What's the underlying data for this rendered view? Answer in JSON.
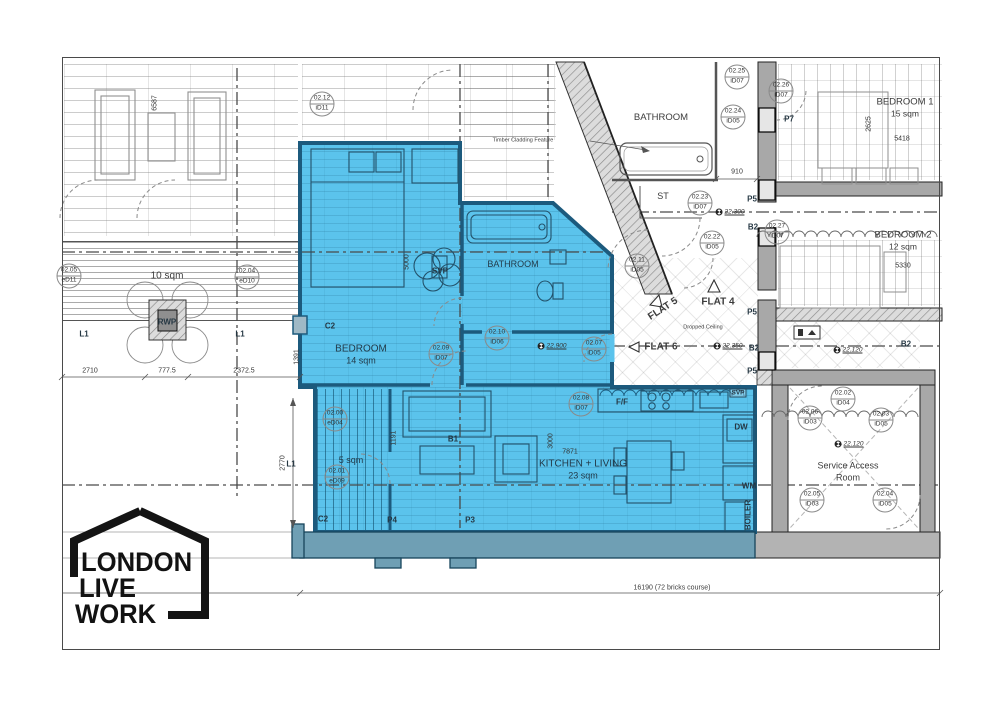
{
  "title": "Live/Work flat floor plan",
  "logo": {
    "line1": "LONDON",
    "line2": "LIVE",
    "line3": "WORK"
  },
  "colors": {
    "highlight": "#5bc3ec",
    "highlight_wall": "#1c5a7d",
    "parapet": "#6f9fb4",
    "wall_grey": "#a8a8a8"
  },
  "rooms": {
    "bedroom": {
      "name": "BEDROOM",
      "area": "14 sqm"
    },
    "bathroom_main": {
      "name": "BATHROOM"
    },
    "kitchen_living": {
      "name": "KITCHEN + LIVING",
      "area": "23 sqm"
    },
    "terrace": {
      "area": "5 sqm"
    },
    "roof_terrace": {
      "area": "10 sqm"
    },
    "bathroom_upper": {
      "name": "BATHROOM"
    },
    "store": {
      "name": "ST"
    },
    "flat4": {
      "name": "FLAT 4"
    },
    "flat5": {
      "name": "FLAT 5"
    },
    "flat6": {
      "name": "FLAT 6"
    },
    "bedroom1": {
      "name": "BEDROOM 1",
      "area": "15 sqm"
    },
    "bedroom2": {
      "name": "BEDROOM 2",
      "area": "12 sqm"
    },
    "service_room": {
      "name": "Service Access",
      "name2": "Room"
    }
  },
  "notes": {
    "timber_cladding": "Timber Cladding Feature",
    "dropped_ceiling": "Dropped Ceiling",
    "overall_dimension": "16190 (72 bricks course)"
  },
  "annotations": {
    "door_tags": [
      {
        "code": "02.12",
        "id": "iD11",
        "x": 322,
        "y": 104
      },
      {
        "code": "02.25",
        "id": "iD07",
        "x": 737,
        "y": 77
      },
      {
        "code": "02.26",
        "id": "iD07",
        "x": 781,
        "y": 91
      },
      {
        "code": "02.24",
        "id": "iD05",
        "x": 733,
        "y": 117
      },
      {
        "code": "02.23",
        "id": "iD07",
        "x": 700,
        "y": 203
      },
      {
        "code": "02.22",
        "id": "iD05",
        "x": 712,
        "y": 243
      },
      {
        "code": "02.11",
        "id": "iD05",
        "x": 637,
        "y": 266
      },
      {
        "code": "02.27",
        "id": "iD07",
        "x": 777,
        "y": 232
      },
      {
        "code": "02.10",
        "id": "iD06",
        "x": 497,
        "y": 338
      },
      {
        "code": "02.09",
        "id": "iD07",
        "x": 441,
        "y": 354
      },
      {
        "code": "02.07",
        "id": "iD05",
        "x": 594,
        "y": 349
      },
      {
        "code": "02.08",
        "id": "iD07",
        "x": 581,
        "y": 404
      },
      {
        "code": "02.05",
        "id": "eD11",
        "x": 69,
        "y": 276
      },
      {
        "code": "02.04",
        "id": "eD10",
        "x": 247,
        "y": 277
      },
      {
        "code": "02.00",
        "id": "eD04",
        "x": 335,
        "y": 419
      },
      {
        "code": "02.01",
        "id": "eD09",
        "x": 337,
        "y": 477
      },
      {
        "code": "02.02",
        "id": "iD04",
        "x": 843,
        "y": 399
      },
      {
        "code": "02.06",
        "id": "iD03",
        "x": 810,
        "y": 418
      },
      {
        "code": "02.03",
        "id": "iD05",
        "x": 881,
        "y": 420
      },
      {
        "code": "02.05",
        "id": "iD03",
        "x": 812,
        "y": 500
      },
      {
        "code": "02.04",
        "id": "iD05",
        "x": 885,
        "y": 500
      }
    ],
    "markers": [
      {
        "text": "P7",
        "x": 789,
        "y": 119
      },
      {
        "text": "P5",
        "x": 752,
        "y": 199
      },
      {
        "text": "P5",
        "x": 752,
        "y": 312
      },
      {
        "text": "P5",
        "x": 752,
        "y": 371
      },
      {
        "text": "P4",
        "x": 392,
        "y": 520
      },
      {
        "text": "P3",
        "x": 470,
        "y": 520
      },
      {
        "text": "B1",
        "x": 453,
        "y": 439
      },
      {
        "text": "B2",
        "x": 753,
        "y": 227
      },
      {
        "text": "B2",
        "x": 754,
        "y": 348
      },
      {
        "text": "B2",
        "x": 906,
        "y": 344
      },
      {
        "text": "C2",
        "x": 330,
        "y": 326
      },
      {
        "text": "C2",
        "x": 323,
        "y": 519
      },
      {
        "text": "L1",
        "x": 84,
        "y": 334
      },
      {
        "text": "L1",
        "x": 240,
        "y": 334
      },
      {
        "text": "L1",
        "x": 291,
        "y": 464
      },
      {
        "text": "SVP",
        "x": 440,
        "y": 271
      },
      {
        "text": "SVP",
        "x": 738,
        "y": 393,
        "box": true
      },
      {
        "text": "RWP",
        "x": 167,
        "y": 322
      },
      {
        "text": "F/F",
        "x": 622,
        "y": 402
      },
      {
        "text": "DW",
        "x": 741,
        "y": 427
      },
      {
        "text": "WM",
        "x": 749,
        "y": 486
      },
      {
        "text": "BOILER",
        "x": 748,
        "y": 515,
        "rot": -90
      }
    ],
    "levels": [
      {
        "text": "22.900",
        "x": 552,
        "y": 346
      },
      {
        "text": "22.300",
        "x": 730,
        "y": 212
      },
      {
        "text": "22.350",
        "x": 728,
        "y": 346
      },
      {
        "text": "22.120",
        "x": 848,
        "y": 350
      },
      {
        "text": "22.120",
        "x": 849,
        "y": 444
      }
    ],
    "dimensions": [
      {
        "text": "6587",
        "x": 155,
        "y": 103,
        "rot": -90
      },
      {
        "text": "5000",
        "x": 407,
        "y": 262,
        "rot": -90
      },
      {
        "text": "2710",
        "x": 90,
        "y": 371
      },
      {
        "text": "777.5",
        "x": 167,
        "y": 371
      },
      {
        "text": "2372.5",
        "x": 244,
        "y": 371
      },
      {
        "text": "1391",
        "x": 297,
        "y": 357,
        "rot": -90
      },
      {
        "text": "2770",
        "x": 283,
        "y": 463,
        "rot": -90
      },
      {
        "text": "1191",
        "x": 394,
        "y": 438,
        "rot": -90
      },
      {
        "text": "3000",
        "x": 551,
        "y": 441,
        "rot": -90
      },
      {
        "text": "7871",
        "x": 570,
        "y": 452
      },
      {
        "text": "910",
        "x": 737,
        "y": 172
      },
      {
        "text": "2625",
        "x": 869,
        "y": 124,
        "rot": -90
      },
      {
        "text": "5418",
        "x": 902,
        "y": 139
      },
      {
        "text": "5330",
        "x": 903,
        "y": 266
      }
    ]
  }
}
